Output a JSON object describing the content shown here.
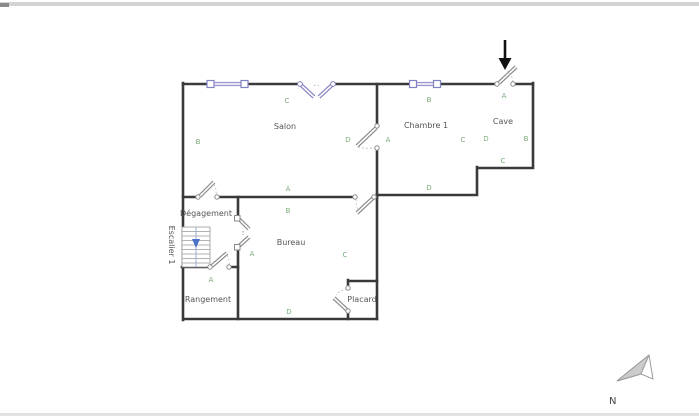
{
  "title": "floor-plan",
  "rooms": {
    "salon": "Salon",
    "chambre1": "Chambre 1",
    "cave": "Cave",
    "degagement": "Dégagement",
    "bureau": "Bureau",
    "rangement": "Rangement",
    "placard": "Placard",
    "escalier1": "Escalier 1"
  },
  "wall_letters": {
    "salon": {
      "top": "C",
      "left": "B",
      "right": "D",
      "bottom": "A"
    },
    "chambre1": {
      "top": "B",
      "left": "A",
      "right": "C",
      "bottom": "D"
    },
    "cave": {
      "top": "A",
      "left": "D",
      "right": "B",
      "bottom": "C"
    },
    "bureau": {
      "top": "B",
      "left": "A",
      "right": "C",
      "bottom": "D"
    },
    "rangement": {
      "top": "A"
    }
  },
  "compass": {
    "label": "N"
  },
  "colors": {
    "wall": "#3a3a3a",
    "thin_line": "#9a9a9a",
    "letter_green": "#7bab7b",
    "room_text": "#555555",
    "window_blue": "#9a9ad0",
    "stair_arrow_blue": "#4a72c8",
    "entrance_arrow": "#111111",
    "north_fill": "#cccccc"
  }
}
